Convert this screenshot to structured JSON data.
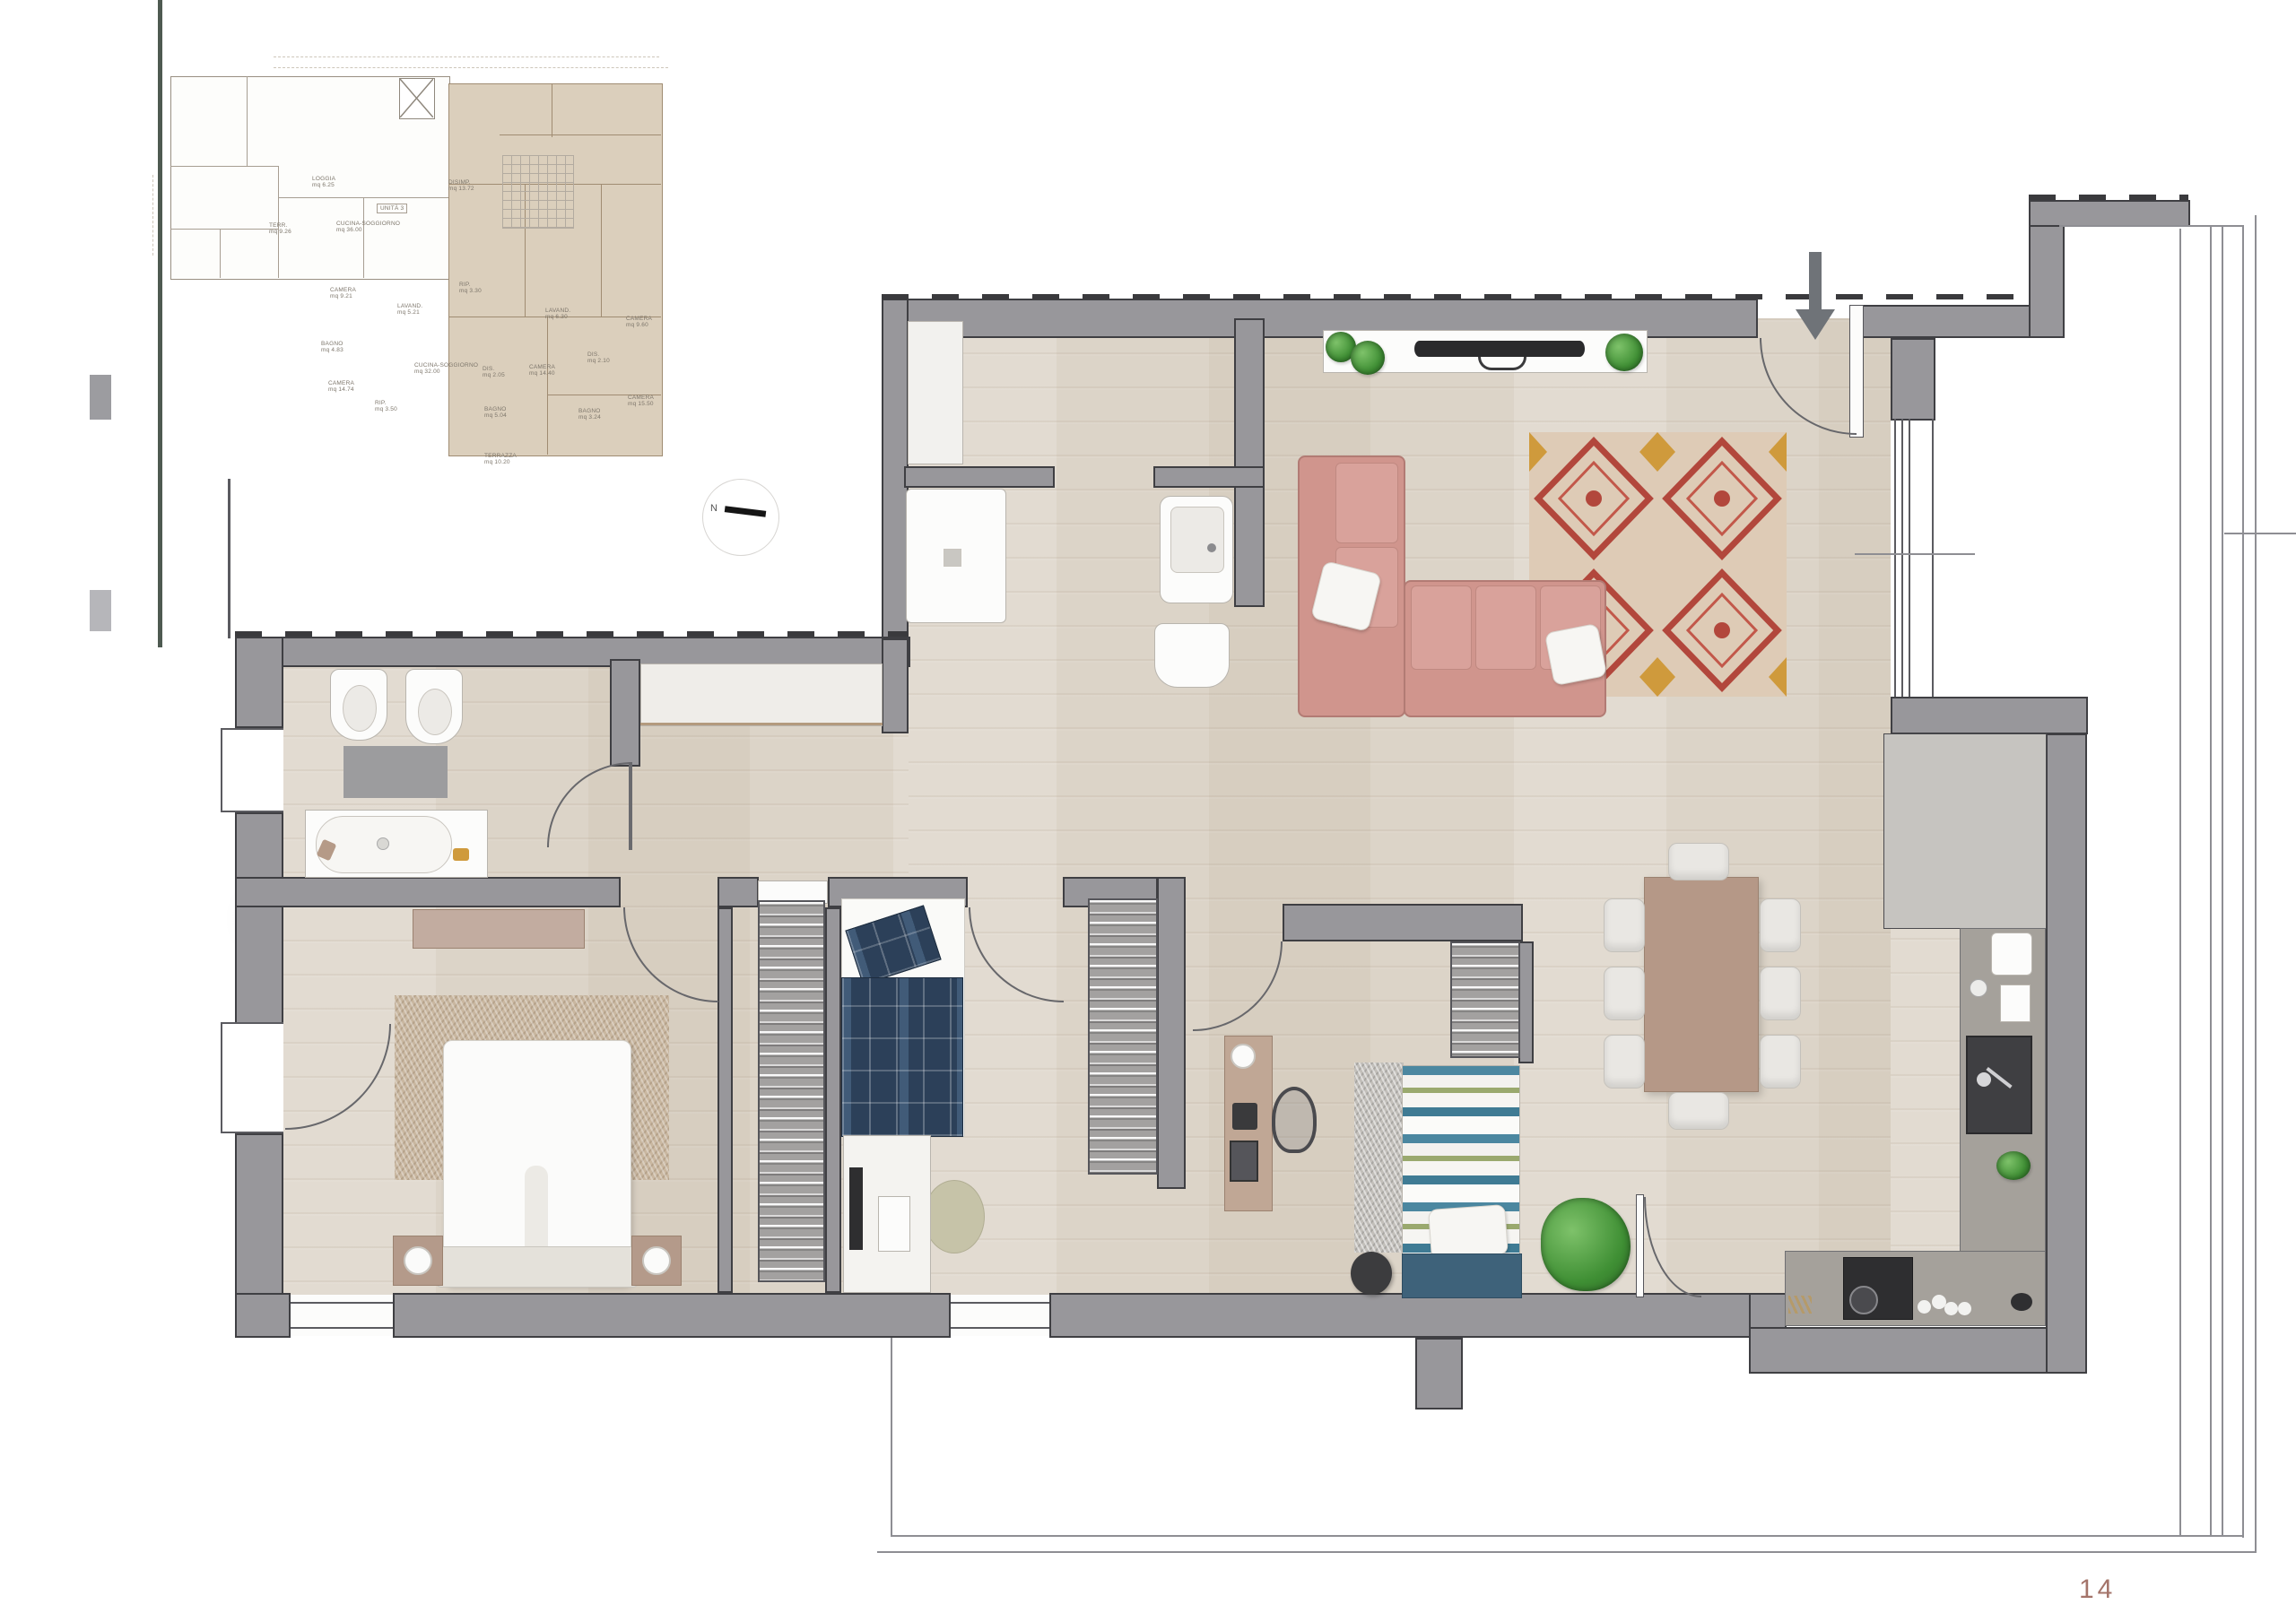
{
  "page": {
    "number": "14"
  },
  "mini_plan": {
    "compass": "N",
    "unit_tag": "UNITÀ 3",
    "rooms": [
      {
        "label": "LOGGIA",
        "area": "mq 6.25"
      },
      {
        "label": "TERR.",
        "area": "mq 9.26"
      },
      {
        "label": "CUCINA-SOGGIORNO",
        "area": "mq 36.00"
      },
      {
        "label": "CAMERA",
        "area": "mq 9.21"
      },
      {
        "label": "DISIMP.",
        "area": "mq 13.72"
      },
      {
        "label": "RIP.",
        "area": "mq 3.30"
      },
      {
        "label": "LAVAND.",
        "area": "mq 5.21"
      },
      {
        "label": "BAGNO",
        "area": "mq 4.83"
      },
      {
        "label": "CAMERA",
        "area": "mq 14.74"
      },
      {
        "label": "RIP.",
        "area": "mq 3.50"
      },
      {
        "label": "CUCINA-SOGGIORNO",
        "area": "mq 32.00"
      },
      {
        "label": "DIS.",
        "area": "mq 2.05"
      },
      {
        "label": "BAGNO",
        "area": "mq 5.04"
      },
      {
        "label": "CAMERA",
        "area": "mq 14.40"
      },
      {
        "label": "TERRAZZA",
        "area": "mq 10.20"
      },
      {
        "label": "LAVAND.",
        "area": "mq 6.30"
      },
      {
        "label": "CAMERA",
        "area": "mq 9.60"
      },
      {
        "label": "DIS.",
        "area": "mq 2.10"
      },
      {
        "label": "CAMERA",
        "area": "mq 15.50"
      },
      {
        "label": "BAGNO",
        "area": "mq 3.24"
      }
    ]
  },
  "colors": {
    "wall": "#98979b",
    "floor": "#dcd4c8",
    "sofa": "#d0958d",
    "highlight_unit": "#dbcfbc",
    "page_number": "#a4746a"
  }
}
